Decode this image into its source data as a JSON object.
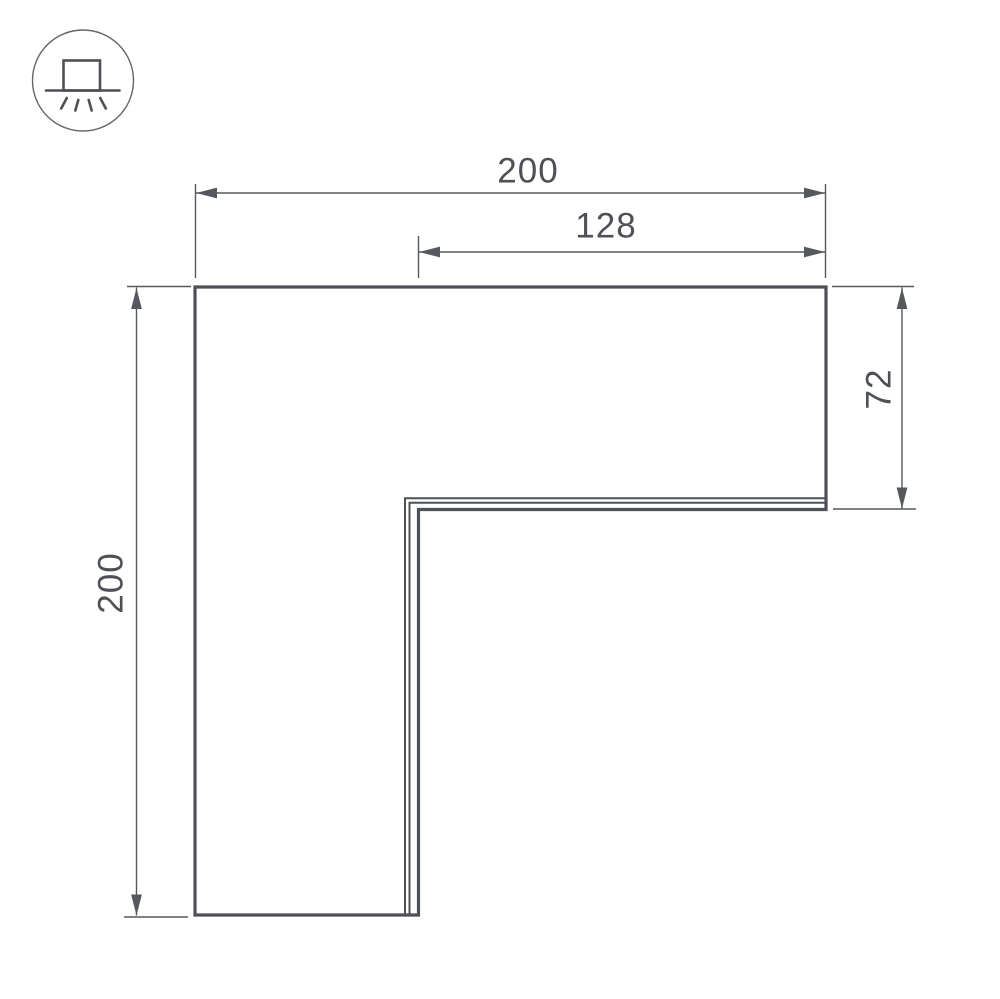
{
  "icon": {
    "name": "surface-mounted-luminaire",
    "description": "circled icon of a box fixture on a ceiling line with light rays shining downward"
  },
  "dimensions": {
    "top_width": "200",
    "top_inner_width": "128",
    "left_height": "200",
    "right_arm_height": "72"
  },
  "colors": {
    "outline": "#4d5156",
    "seam": "#4d5156",
    "dimension": "#55585c",
    "label": "#4d5156",
    "icon": "#4d5156",
    "icon_circle": "#63676c",
    "background": "#ffffff"
  }
}
